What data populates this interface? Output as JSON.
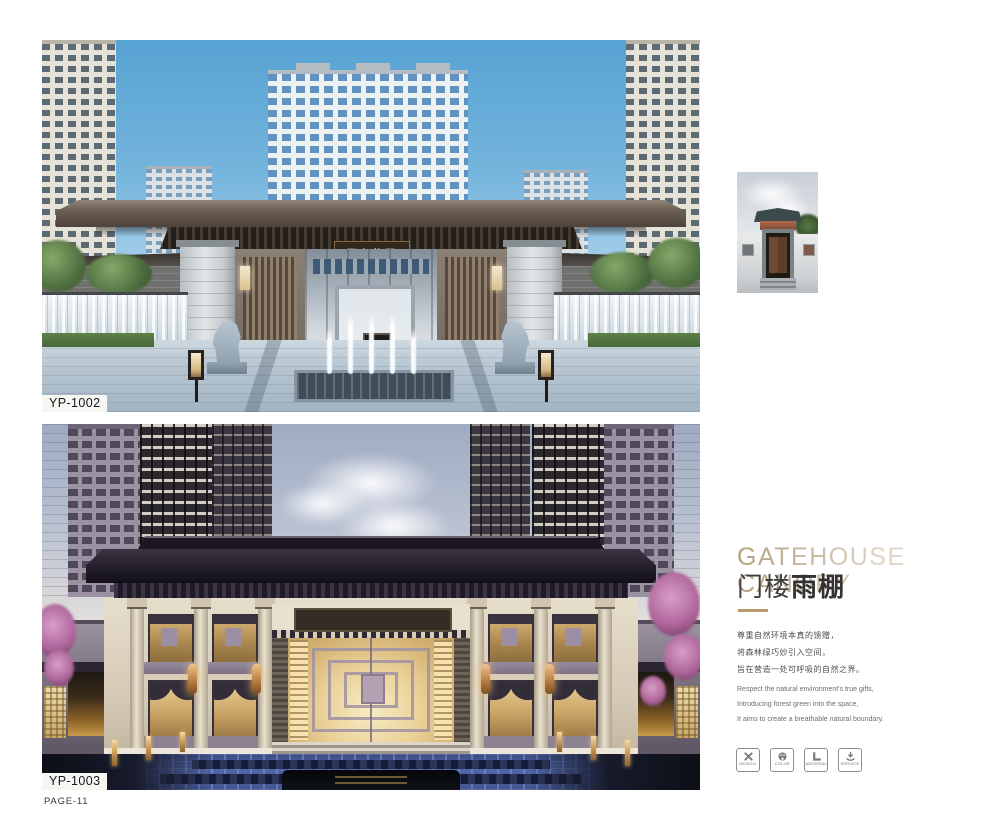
{
  "page": {
    "number_label": "PAGE-11"
  },
  "figures": {
    "top": {
      "code": "YP-1002",
      "plaque": "都市花园"
    },
    "bottom": {
      "code": "YP-1003"
    }
  },
  "sidebar": {
    "title": {
      "en_line1": "GATEHOUSE",
      "en_line2": "CANOPY",
      "zh_light": "门楼",
      "zh_bold": "雨棚"
    },
    "paragraph_zh": [
      "尊重自然环境本真的馈赠，",
      "将森林绿巧妙引入空间，",
      "旨在营造一处可呼吸的自然之界。"
    ],
    "paragraph_en": [
      "Respect the natural environment's true gifts,",
      "Introducing forest green into the space,",
      "It aims to create a breathable natural boundary."
    ],
    "badges": [
      {
        "icon": "design-icon",
        "label": "DESIGN"
      },
      {
        "icon": "color-icon",
        "label": "COLOR"
      },
      {
        "icon": "material-icon",
        "label": "MATERIAL"
      },
      {
        "icon": "service-icon",
        "label": "SERVICE"
      }
    ],
    "colors": {
      "accent_gold": "#b79c6e",
      "title_gold": "#c6b594",
      "title_dark": "#3d3d3d"
    }
  }
}
